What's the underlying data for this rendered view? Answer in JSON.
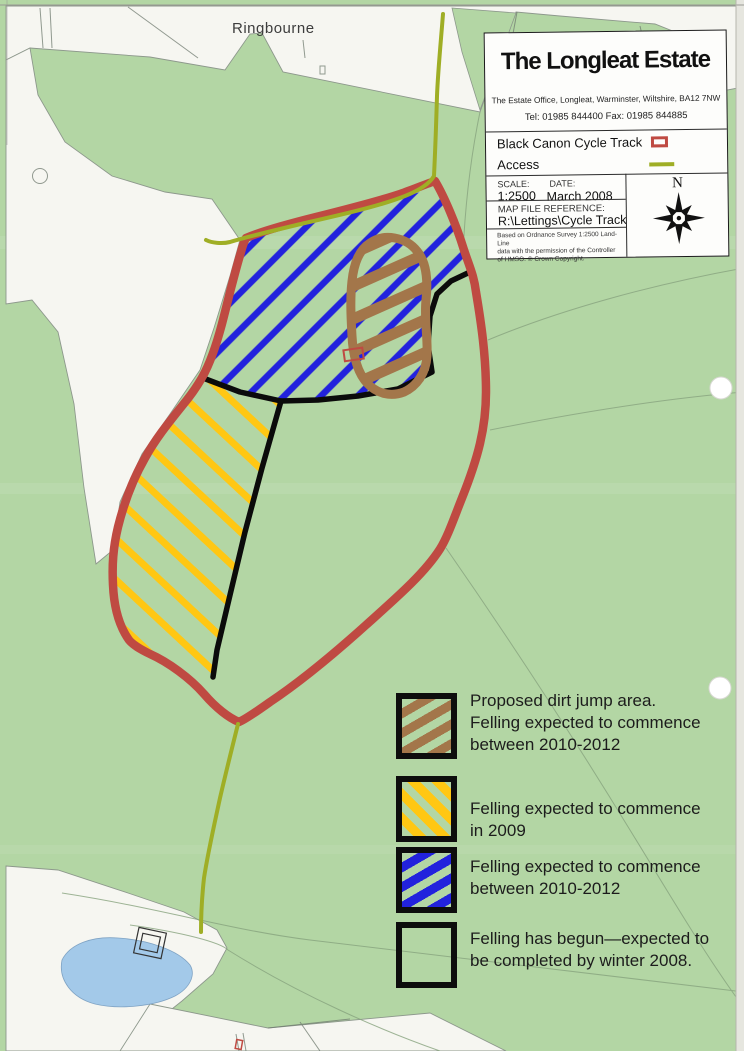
{
  "header": {
    "title": "The Longleat Estate",
    "address": "The Estate Office, Longleat, Warminster, Wiltshire, BA12 7NW",
    "phone": "Tel: 01985 844400  Fax: 01985 844885",
    "track_label": "Black Canon Cycle Track",
    "access_label": "Access",
    "scale_label": "SCALE:",
    "scale_value": "1:2500",
    "date_label": "DATE:",
    "date_value": "March 2008",
    "file_ref_label": "MAP FILE REFERENCE:",
    "file_ref_value": "R:\\Lettings\\Cycle Track",
    "copyright_line1": "Based on Ordnance Survey 1:2500 Land-Line",
    "copyright_line2": "data with the permission of the Controller",
    "copyright_line3": "of HMSO. © Crown Copyright.",
    "compass_label": "N"
  },
  "map": {
    "place_label": "Ringbourne"
  },
  "felling_legend": {
    "items": [
      {
        "id": "dirt-jump-area",
        "lines": [
          "Proposed dirt jump area.",
          "Felling expected to commence",
          "between 2010-2012"
        ]
      },
      {
        "id": "felling-2009",
        "lines": [
          "Felling expected to commence",
          "in 2009"
        ]
      },
      {
        "id": "felling-2010-2012",
        "lines": [
          "Felling expected to commence",
          "between 2010-2012"
        ]
      },
      {
        "id": "felling-begun",
        "lines": [
          "Felling has begun—expected to",
          "be completed by winter 2008."
        ]
      }
    ]
  },
  "colors": {
    "track_red": "#bf4a42",
    "access_olive": "#9fae25",
    "hatch_blue": "#2222dd",
    "hatch_yellow": "#ffc713",
    "hatch_brown": "#a3764a",
    "map_green": "#b3d6a4",
    "pond_blue": "#a3c9e9"
  }
}
